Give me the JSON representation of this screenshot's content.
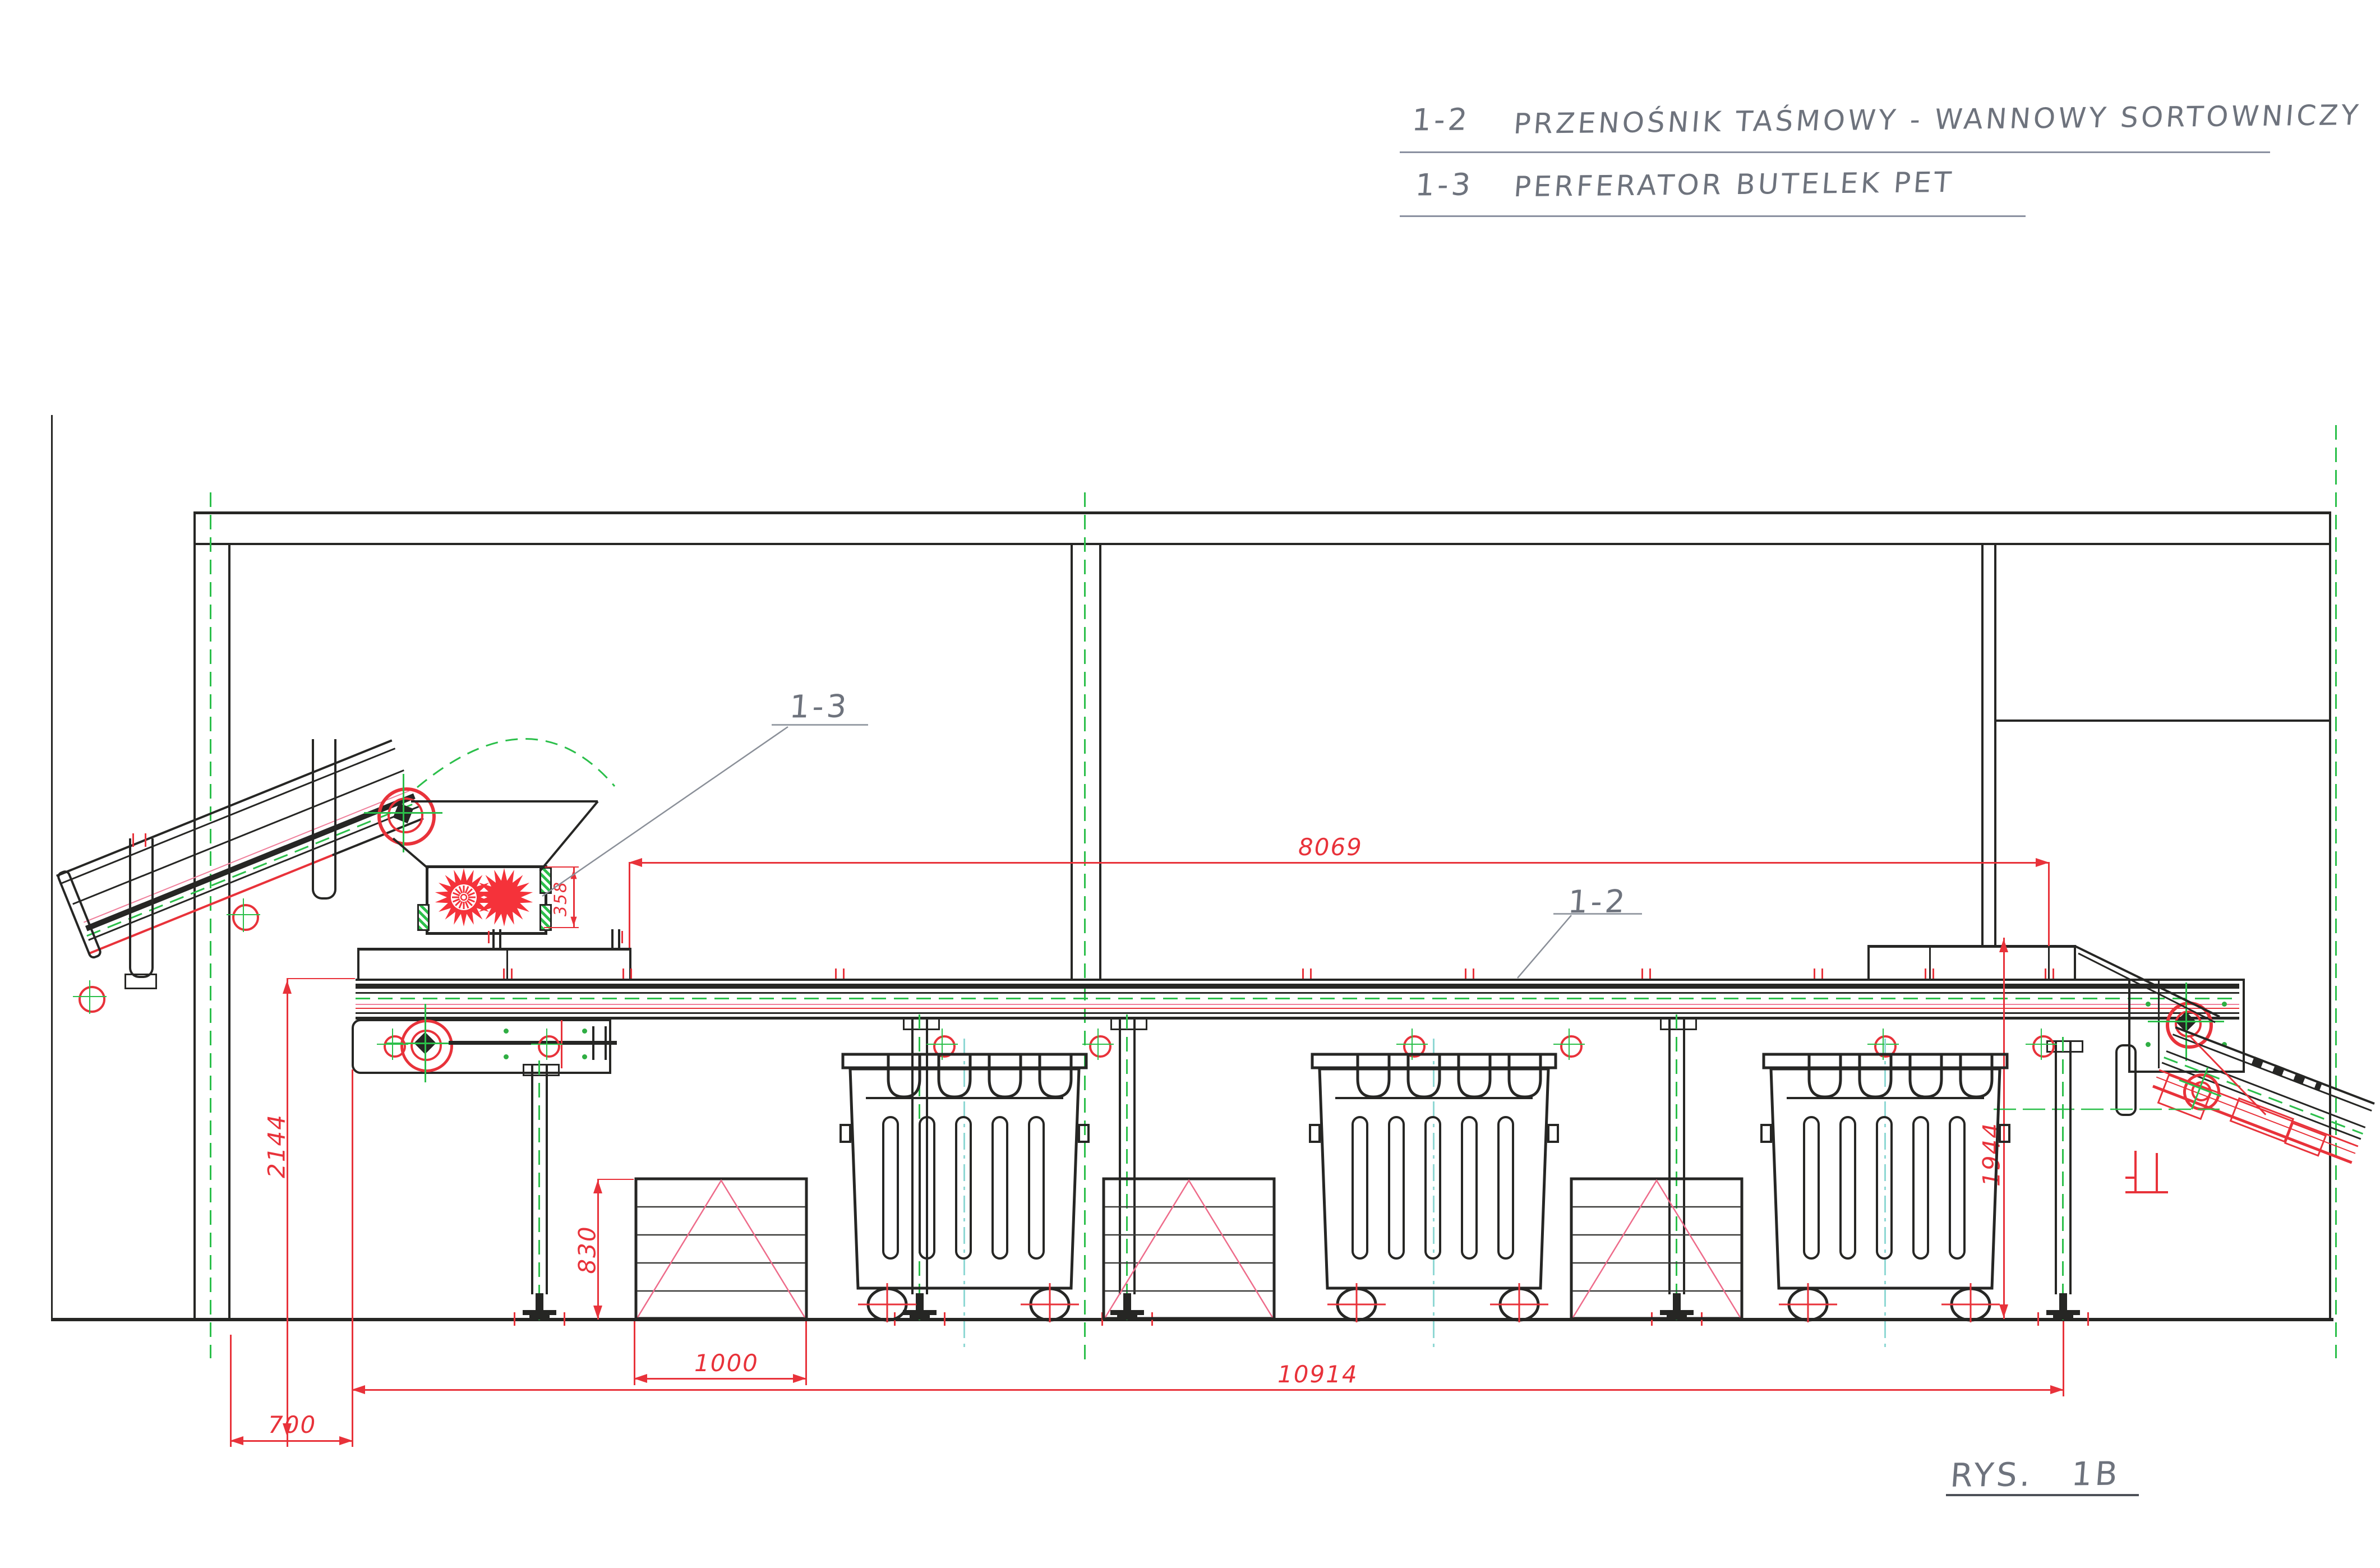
{
  "title_block": {
    "row1_id": "1-2",
    "row1_text": "PRZENOŚNIK TAŚMOWY - WANNOWY SORTOWNICZY",
    "row2_id": "1-3",
    "row2_text": "PERFERATOR BUTELEK PET"
  },
  "callouts": {
    "perforator": "1-3",
    "sorting_conveyor": "1-2"
  },
  "dimensions": {
    "sorting_section_span": "8069",
    "total_line_length": "10914",
    "left_conveyor_height": "2144",
    "right_conveyor_height": "1944",
    "bale_stack_height": "830",
    "bale_stack_width": "1000",
    "tail_offset": "700",
    "perforator_opening": "358"
  },
  "drawing_ref": {
    "label": "RYS.",
    "number": "1B"
  },
  "colors": {
    "dimension_red": "#e8323a",
    "centerline_green": "#2bbf4a",
    "ink_black": "#262624",
    "pencil_gray": "#6e737d",
    "belt_pink": "#ef7e9a",
    "container_cyan": "#8fd8d4",
    "star_red": "#f5323a"
  }
}
